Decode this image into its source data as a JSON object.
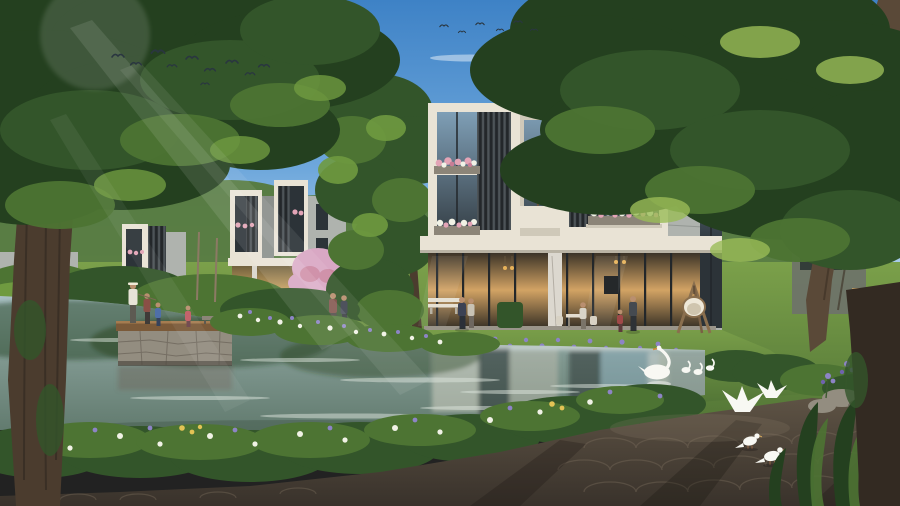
{
  "meta": {
    "description": "Photorealistic architectural exterior render: modern lakeside villa community on a sunny day",
    "image_width": 900,
    "image_height": 506
  },
  "palette": {
    "sky_top": "#3e82c6",
    "sky_mid": "#6fa8dc",
    "sky_horizon": "#c6ddf0",
    "cloud": "#ffffff",
    "bird": "#2a3640",
    "foliage_deep": "#24401f",
    "foliage_dark": "#33552a",
    "foliage_mid": "#4d7433",
    "foliage_light": "#6f9a40",
    "foliage_sun": "#9abc57",
    "treeline": "#567a3c",
    "trunk": "#4b3c2e",
    "trunk_dark": "#332a22",
    "trunk_right": "#5a4938",
    "building_cream": "#e9e3d5",
    "building_cream_shade": "#cfc9b9",
    "wall_gray": "#afb3ae",
    "wall_gray_dark": "#8a8f8b",
    "louver_dark": "#23272a",
    "louver_light": "#4d5458",
    "glass_sky": "#8fb4cf",
    "glass_dark": "#2c3338",
    "interior_dark": "#2f2a22",
    "interior_glow": "#d2a364",
    "marble": "#dcd8cf",
    "fascia_shadow": "#b9b3a4",
    "water_far": "#a9bfc4",
    "water_mid": "#7e968e",
    "water_near": "#5c7568",
    "ripple": "#dde6de",
    "stone": "#938d80",
    "stone_dark": "#6e675c",
    "deck": "#7b5a39",
    "lawn": "#7ba04a",
    "lawn_dark": "#527536",
    "flower_purple": "#8d84c6",
    "flower_violet": "#6f63ad",
    "flower_white": "#f1f2e6",
    "flower_pink": "#e3a4b6",
    "flower_rose": "#c87d96",
    "flower_yellow": "#e3c355",
    "blossom_pink": "#d9a8c4",
    "path_lit": "#5d5244",
    "path_shadow": "#39322b",
    "cobble_line": "#7b6e5d",
    "swan_white": "#f8f8f3",
    "skin": "#b98f6f",
    "swing_wood": "#8a6f4e",
    "ray": "#ffffff"
  },
  "scene": {
    "sky": {
      "birds_in_flight": 16,
      "clouds": "faint thin wisps"
    },
    "buildings": {
      "main_villa": {
        "storeys": 3,
        "facade": "two cream picture-frame volumes with dark vertical louvres, glazed balconies with flower boxes, fully glazed warm-lit ground floor"
      },
      "background_villas": 4
    },
    "water": {
      "type": "lake",
      "features": [
        "building reflections",
        "tree reflections",
        "sky ripples"
      ]
    },
    "wildlife": {
      "swan_adults": 1,
      "swan_cygnets": 3,
      "doves_flying": 2,
      "doves_on_path": 2
    },
    "people": {
      "on_pier": 4,
      "walking_on_lawn": 2,
      "in_villa_garden": 5,
      "on_balcony": 2
    },
    "landscape": [
      "stone fishing pier with wooden deck",
      "lavender and white flower banks",
      "curved cobblestone walkway with fan paving",
      "hanging egg swing",
      "large framing trees left and right",
      "sun rays through foliage"
    ]
  }
}
